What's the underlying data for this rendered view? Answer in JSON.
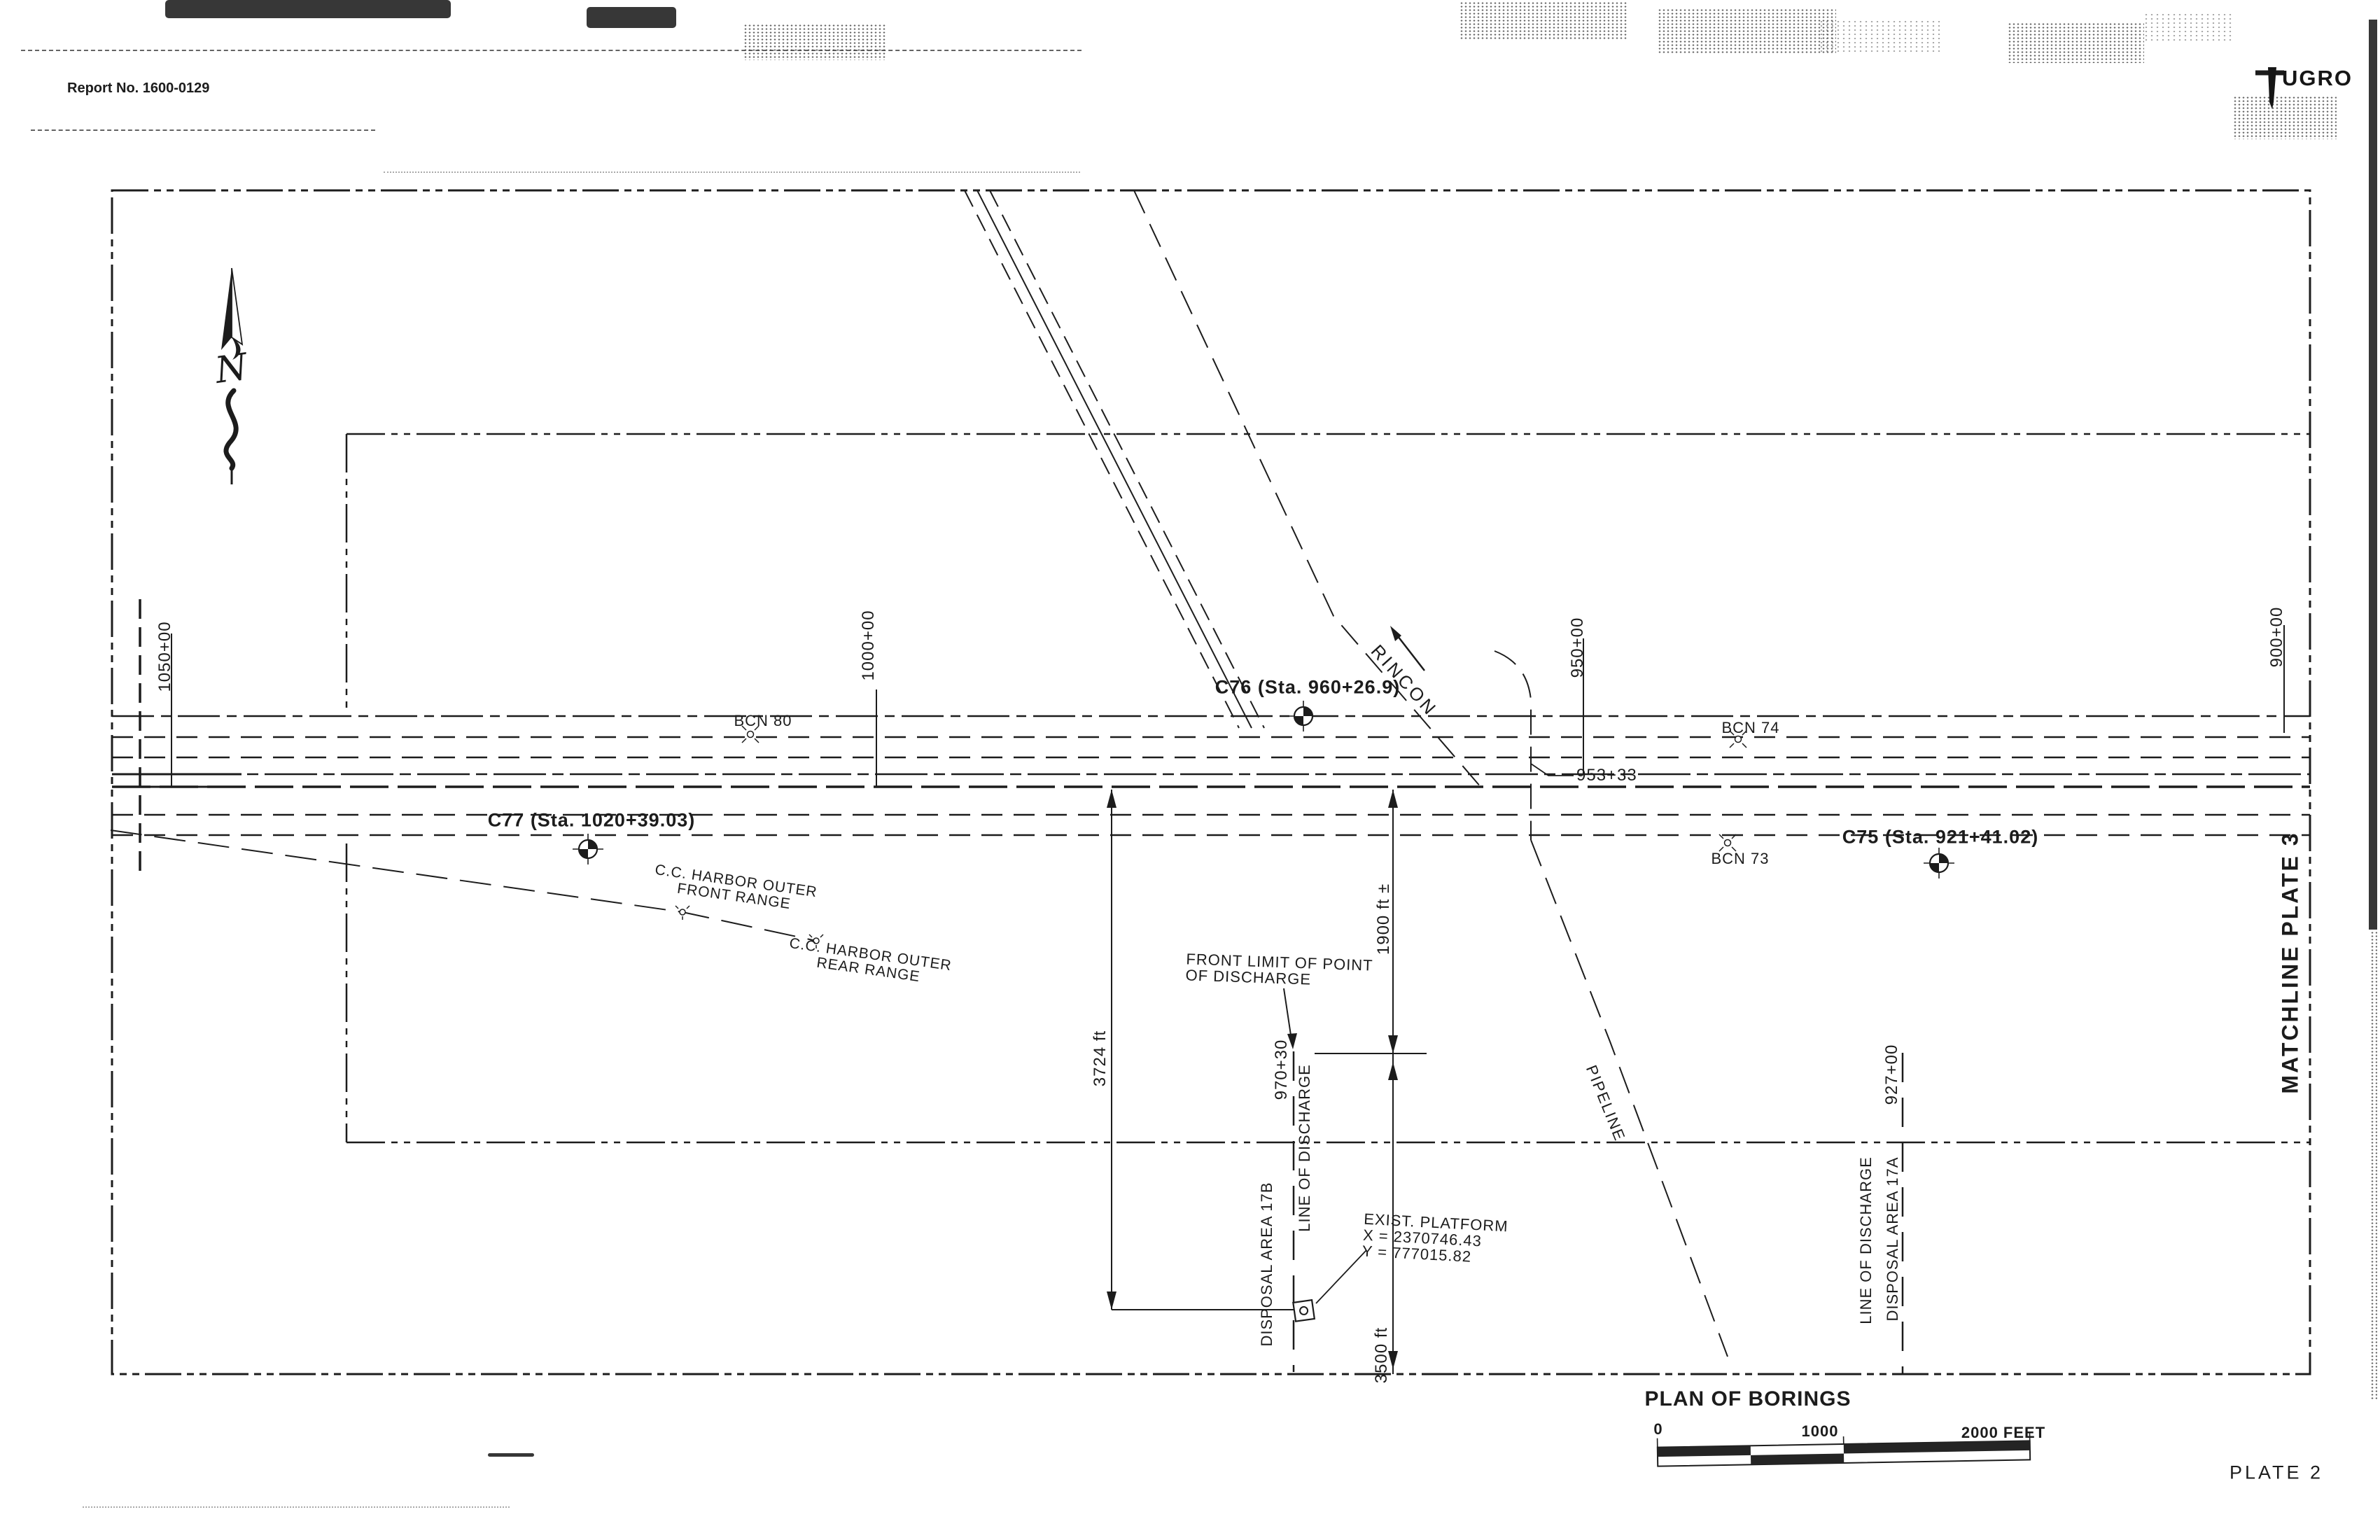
{
  "header": {
    "report_no": "Report No. 1600-0129"
  },
  "logo": {
    "brand": "UGRO"
  },
  "north_arrow": {
    "label": "N"
  },
  "stations": {
    "s1050": "1050+00",
    "s1000": "1000+00",
    "s950": "950+00",
    "s900": "900+00",
    "s927": "927+00",
    "s970_30": "970+30",
    "s953_33": "953+33"
  },
  "borings": {
    "c77": "C77 (Sta. 1020+39.03)",
    "c76": "C76 (Sta. 960+26.9)",
    "c75": "C75 (Sta. 921+41.02)"
  },
  "beacons": {
    "bcn80": "BCN 80",
    "bcn74": "BCN 74",
    "bcn73": "BCN 73"
  },
  "ranges": {
    "front_line1": "C.C. HARBOR OUTER",
    "front_line2": "FRONT RANGE",
    "rear_line1": "C.C. HARBOR OUTER",
    "rear_line2": "REAR RANGE"
  },
  "features": {
    "rincon": "RINCON",
    "pipeline": "PIPELINE",
    "front_limit_line1": "FRONT LIMIT OF POINT",
    "front_limit_line2": "OF DISCHARGE",
    "discharge_b_line": "LINE OF DISCHARGE",
    "discharge_b_area": "DISPOSAL AREA 17B",
    "discharge_a_line": "LINE OF DISCHARGE",
    "discharge_a_area": "DISPOSAL AREA 17A",
    "platform_line1": "EXIST. PLATFORM",
    "platform_line2": "X = 2370746.43",
    "platform_line3": "Y = 777015.82",
    "matchline": "MATCHLINE PLATE 3"
  },
  "dimensions": {
    "d3724": "3724 ft",
    "d1900": "1900 ft ±",
    "d3500": "3500 ft"
  },
  "title_block": {
    "title": "PLAN OF BORINGS",
    "plate": "PLATE 2"
  },
  "scale_bar": {
    "t0": "0",
    "t1000": "1000",
    "t2000": "2000 FEET"
  },
  "colors": {
    "ink": "#1c1c1c",
    "paper": "#ffffff"
  }
}
